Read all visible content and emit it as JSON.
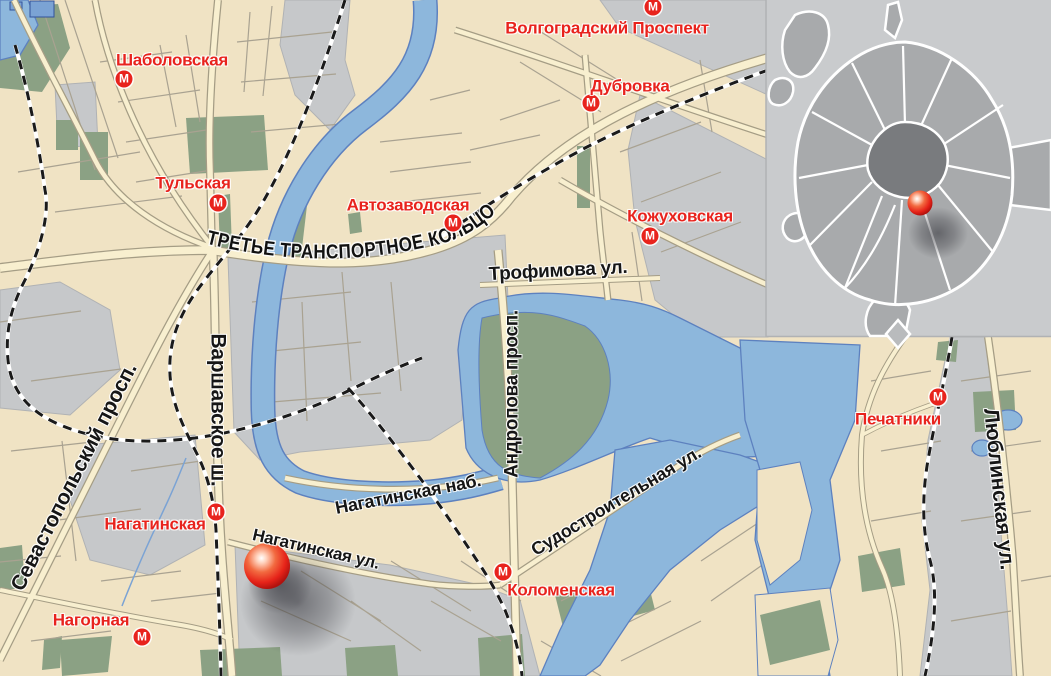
{
  "map": {
    "metro_icon_letter": "М",
    "stations": [
      {
        "name": "Шаболовская"
      },
      {
        "name": "Тульская"
      },
      {
        "name": "Автозаводская"
      },
      {
        "name": "Волгоградский Проспект"
      },
      {
        "name": "Дубровка"
      },
      {
        "name": "Кожуховская"
      },
      {
        "name": "Печатники"
      },
      {
        "name": "Нагатинская"
      },
      {
        "name": "Нагорная"
      },
      {
        "name": "Коломенская"
      }
    ],
    "streets": {
      "ttk": "ТРЕТЬЕ ТРАНСПОРТНОЕ КОЛЬЦО",
      "trofimova": "Трофимова ул.",
      "andropova": "Андропова просп.",
      "varshavskoe": "Варшавское ш.",
      "sevastopolsky": "Севастопольский просп.",
      "nagatinskaya_nab": "Нагатинская наб.",
      "nagatinskaya_ul": "Нагатинская ул.",
      "sudostroitelnaya": "Судостроительная ул.",
      "lyublinskaya": "Люблинская ул."
    },
    "colors": {
      "land": "#f0e3c4",
      "blocks_gray": "#c6c8ca",
      "water_blue": "#8db7dc",
      "park_green": "#8ba184",
      "road_fill": "#f8efcf",
      "metro_red": "#e8231d",
      "marker_red": "#e62319",
      "inset_gray": "#c9cbcd"
    }
  }
}
